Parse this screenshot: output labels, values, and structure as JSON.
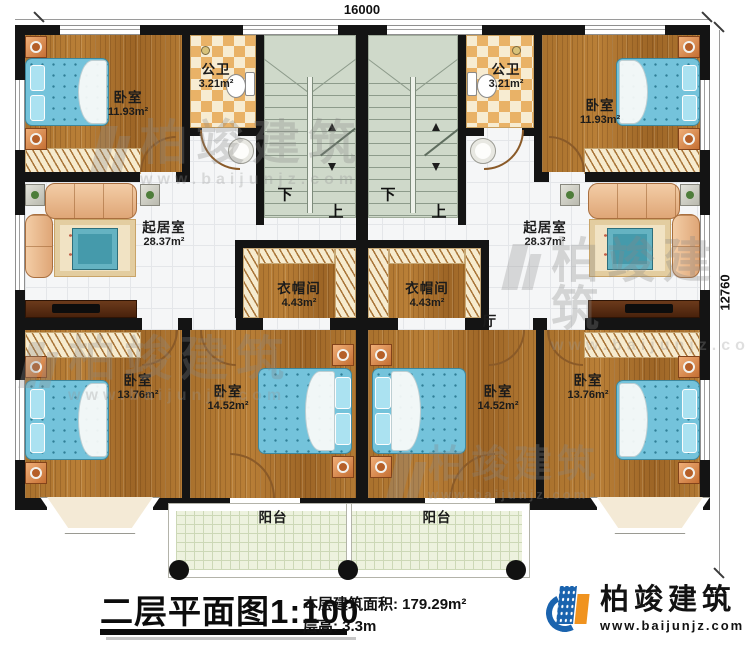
{
  "dimensions": {
    "top": "16000",
    "right": "12760"
  },
  "stairs": {
    "down": "下",
    "up": "上"
  },
  "rooms": {
    "bedroom_tl": {
      "name": "卧室",
      "area": "11.93m²"
    },
    "bath_tl": {
      "name": "公卫",
      "area": "3.21m²"
    },
    "bath_tr": {
      "name": "公卫",
      "area": "3.21m²"
    },
    "bedroom_tr": {
      "name": "卧室",
      "area": "11.93m²"
    },
    "living_l": {
      "name": "起居室",
      "area": "28.37m²"
    },
    "living_r": {
      "name": "起居室",
      "area": "28.37m²"
    },
    "closet_l": {
      "name": "衣帽间",
      "area": "4.43m²"
    },
    "closet_r": {
      "name": "衣帽间",
      "area": "4.43m²"
    },
    "hall": {
      "name": "厅"
    },
    "bedroom_bl": {
      "name": "卧室",
      "area": "13.76m²"
    },
    "bedroom_bml": {
      "name": "卧室",
      "area": "14.52m²"
    },
    "bedroom_bmr": {
      "name": "卧室",
      "area": "14.52m²"
    },
    "bedroom_br": {
      "name": "卧室",
      "area": "13.76m²"
    },
    "balcony_l": {
      "name": "阳台"
    },
    "balcony_r": {
      "name": "阳台"
    }
  },
  "title_block": {
    "title": "二层平面图",
    "scale": "1:100",
    "area_label": "本层建筑面积:",
    "area_value": "179.29m²",
    "height_label": "层高:",
    "height_value": "3.3m"
  },
  "logo": {
    "name": "柏竣建筑",
    "website": "www.baijunjz.com"
  },
  "watermark": {
    "text": "柏竣建筑",
    "website": "www.baijunjz.com"
  },
  "colors": {
    "wall": "#141414",
    "wood_floor": "#a9712d",
    "bath_tile": "#e9b267",
    "stair": "#cfd9ca",
    "bed": "#74c3db",
    "logo_blue": "#1a63ae",
    "logo_orange": "#f0931f"
  }
}
